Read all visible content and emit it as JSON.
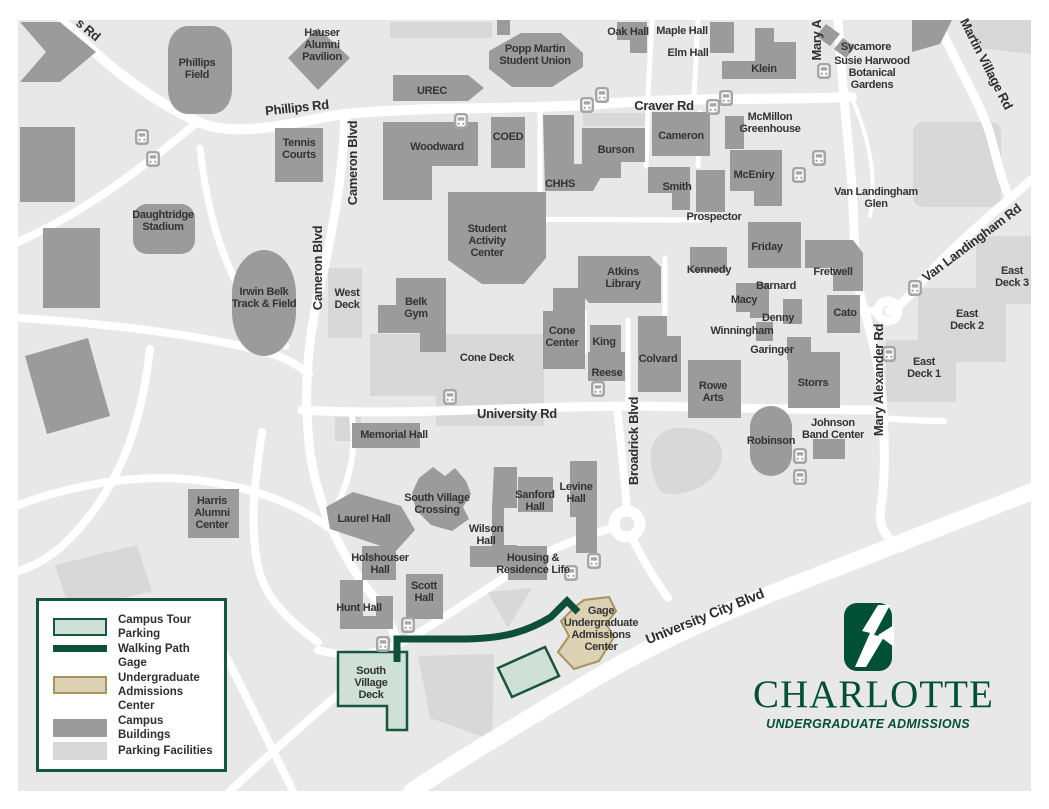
{
  "legend": {
    "items": [
      {
        "id": "campus-tour-parking",
        "label": "Campus Tour Parking",
        "swatch": "tour-parking"
      },
      {
        "id": "walking-path",
        "label": "Walking Path",
        "swatch": "walking-path"
      },
      {
        "id": "gage-center",
        "label": "Gage Undergraduate Admissions Center",
        "swatch": "gage"
      },
      {
        "id": "campus-buildings",
        "label": "Campus Buildings",
        "swatch": "building"
      },
      {
        "id": "parking-facilities",
        "label": "Parking Facilities",
        "swatch": "parking"
      }
    ]
  },
  "branding": {
    "wordmark": "CHARLOTTE",
    "tagline": "UNDERGRADUATE ADMISSIONS"
  },
  "colors": {
    "charlotte_green": "#005035",
    "walking_path": "#0d4f38",
    "tour_parking_fill": "#cfe0d6",
    "tour_parking_border": "#15563c",
    "gage_fill": "#ddd1b3",
    "gage_border": "#a8925e",
    "campus_building": "#9b9b9b",
    "parking": "#d8d8d8",
    "map_background": "#e8e8e8",
    "label_text": "#333333"
  },
  "map": {
    "bus_stops": [
      [
        142,
        137
      ],
      [
        153,
        159
      ],
      [
        461,
        121
      ],
      [
        587,
        105
      ],
      [
        602,
        95
      ],
      [
        713,
        107
      ],
      [
        726,
        98
      ],
      [
        824,
        71
      ],
      [
        819,
        158
      ],
      [
        799,
        175
      ],
      [
        915,
        288
      ],
      [
        889,
        354
      ],
      [
        450,
        397
      ],
      [
        598,
        389
      ],
      [
        800,
        456
      ],
      [
        800,
        477
      ],
      [
        571,
        573
      ],
      [
        594,
        561
      ],
      [
        408,
        625
      ],
      [
        383,
        644
      ]
    ],
    "labels": [
      {
        "id": "s-rd-partial",
        "kind": "road",
        "x": 88,
        "y": 30,
        "text": "s Rd",
        "rotate": 40
      },
      {
        "id": "phillips-rd",
        "kind": "road",
        "x": 297,
        "y": 108,
        "text": "Phillips Rd",
        "rotate": -6
      },
      {
        "id": "craver-rd",
        "kind": "road",
        "x": 664,
        "y": 106,
        "text": "Craver Rd"
      },
      {
        "id": "cameron-blvd-north",
        "kind": "road",
        "x": 353,
        "y": 163,
        "text": "Cameron Blvd",
        "rotate": -90
      },
      {
        "id": "cameron-blvd-south",
        "kind": "road",
        "x": 318,
        "y": 268,
        "text": "Cameron Blvd",
        "rotate": -90
      },
      {
        "id": "mary-a-partial",
        "kind": "road",
        "x": 817,
        "y": 40,
        "text": "Mary A",
        "rotate": -90
      },
      {
        "id": "martin-village-rd",
        "kind": "road",
        "x": 986,
        "y": 64,
        "text": "Martin Village Rd",
        "rotate": 63
      },
      {
        "id": "van-landingham-rd",
        "kind": "road",
        "x": 972,
        "y": 243,
        "text": "Van Landingham Rd",
        "rotate": -37
      },
      {
        "id": "mary-alexander-rd",
        "kind": "road",
        "x": 879,
        "y": 380,
        "text": "Mary Alexander Rd",
        "rotate": -90
      },
      {
        "id": "university-rd",
        "kind": "road",
        "x": 517,
        "y": 414,
        "text": "University Rd"
      },
      {
        "id": "broadrick-blvd",
        "kind": "road",
        "x": 634,
        "y": 441,
        "text": "Broadrick Blvd",
        "rotate": -90
      },
      {
        "id": "university-city-blvd",
        "kind": "road",
        "x": 705,
        "y": 617,
        "text": "University City Blvd",
        "rotate": -22,
        "size": 14
      },
      {
        "id": "susie-harwood-botanical-gardens",
        "kind": "area",
        "x": 872,
        "y": 72,
        "lines": [
          "Susie Harwood",
          "Botanical",
          "Gardens"
        ]
      },
      {
        "id": "van-landingham-glen",
        "kind": "area",
        "x": 876,
        "y": 197,
        "lines": [
          "Van Landingham",
          "Glen"
        ]
      },
      {
        "id": "phillips-field",
        "kind": "building",
        "x": 197,
        "y": 68,
        "lines": [
          "Phillips",
          "Field"
        ]
      },
      {
        "id": "hauser-alumni-pavilion",
        "kind": "building",
        "x": 322,
        "y": 44,
        "lines": [
          "Hauser",
          "Alumni",
          "Pavilion"
        ]
      },
      {
        "id": "tennis-courts",
        "kind": "building",
        "x": 299,
        "y": 148,
        "lines": [
          "Tennis",
          "Courts"
        ]
      },
      {
        "id": "daughtridge-stadium",
        "kind": "building",
        "x": 163,
        "y": 220,
        "lines": [
          "Daughtridge",
          "Stadium"
        ]
      },
      {
        "id": "urec",
        "kind": "building",
        "x": 432,
        "y": 90,
        "text": "UREC"
      },
      {
        "id": "popp-martin-student-union",
        "kind": "building",
        "x": 535,
        "y": 54,
        "lines": [
          "Popp Martin",
          "Student Union"
        ]
      },
      {
        "id": "oak-hall",
        "kind": "building",
        "x": 628,
        "y": 31,
        "text": "Oak Hall"
      },
      {
        "id": "maple-hall",
        "kind": "building",
        "x": 682,
        "y": 30,
        "text": "Maple Hall"
      },
      {
        "id": "elm-hall",
        "kind": "building",
        "x": 688,
        "y": 52,
        "text": "Elm Hall"
      },
      {
        "id": "klein",
        "kind": "building",
        "x": 764,
        "y": 68,
        "text": "Klein"
      },
      {
        "id": "sycamore",
        "kind": "building",
        "x": 866,
        "y": 46,
        "text": "Sycamore"
      },
      {
        "id": "woodward",
        "kind": "building",
        "x": 437,
        "y": 146,
        "text": "Woodward"
      },
      {
        "id": "coed",
        "kind": "building",
        "x": 508,
        "y": 136,
        "text": "COED"
      },
      {
        "id": "chhs",
        "kind": "building",
        "x": 560,
        "y": 183,
        "text": "CHHS"
      },
      {
        "id": "burson",
        "kind": "building",
        "x": 616,
        "y": 149,
        "text": "Burson"
      },
      {
        "id": "cameron",
        "kind": "building",
        "x": 681,
        "y": 135,
        "text": "Cameron"
      },
      {
        "id": "mcmillon-greenhouse",
        "kind": "building",
        "x": 770,
        "y": 122,
        "lines": [
          "McMillon",
          "Greenhouse"
        ]
      },
      {
        "id": "mceniry",
        "kind": "building",
        "x": 754,
        "y": 174,
        "text": "McEniry"
      },
      {
        "id": "smith",
        "kind": "building",
        "x": 677,
        "y": 186,
        "text": "Smith"
      },
      {
        "id": "prospector",
        "kind": "building",
        "x": 714,
        "y": 216,
        "text": "Prospector"
      },
      {
        "id": "friday",
        "kind": "building",
        "x": 767,
        "y": 246,
        "text": "Friday"
      },
      {
        "id": "kennedy",
        "kind": "building",
        "x": 709,
        "y": 269,
        "text": "Kennedy"
      },
      {
        "id": "barnard",
        "kind": "building",
        "x": 776,
        "y": 285,
        "text": "Barnard"
      },
      {
        "id": "macy",
        "kind": "building",
        "x": 744,
        "y": 299,
        "text": "Macy"
      },
      {
        "id": "denny",
        "kind": "building",
        "x": 778,
        "y": 317,
        "text": "Denny"
      },
      {
        "id": "winningham",
        "kind": "building",
        "x": 742,
        "y": 330,
        "text": "Winningham"
      },
      {
        "id": "garinger",
        "kind": "building",
        "x": 772,
        "y": 349,
        "text": "Garinger"
      },
      {
        "id": "fretwell",
        "kind": "building",
        "x": 833,
        "y": 271,
        "text": "Fretwell"
      },
      {
        "id": "cato",
        "kind": "building",
        "x": 845,
        "y": 312,
        "text": "Cato"
      },
      {
        "id": "east-deck-3",
        "kind": "deck",
        "x": 1012,
        "y": 276,
        "lines": [
          "East",
          "Deck 3"
        ]
      },
      {
        "id": "east-deck-2",
        "kind": "deck",
        "x": 967,
        "y": 319,
        "lines": [
          "East",
          "Deck 2"
        ]
      },
      {
        "id": "east-deck-1",
        "kind": "deck",
        "x": 924,
        "y": 367,
        "lines": [
          "East",
          "Deck 1"
        ]
      },
      {
        "id": "atkins-library",
        "kind": "building",
        "x": 623,
        "y": 277,
        "lines": [
          "Atkins",
          "Library"
        ]
      },
      {
        "id": "student-activity-center",
        "kind": "building",
        "x": 487,
        "y": 240,
        "lines": [
          "Student",
          "Activity",
          "Center"
        ]
      },
      {
        "id": "west-deck",
        "kind": "deck",
        "x": 347,
        "y": 298,
        "lines": [
          "West",
          "Deck"
        ]
      },
      {
        "id": "belk-gym",
        "kind": "building",
        "x": 416,
        "y": 307,
        "lines": [
          "Belk",
          "Gym"
        ]
      },
      {
        "id": "cone-deck",
        "kind": "deck",
        "x": 487,
        "y": 357,
        "text": "Cone Deck"
      },
      {
        "id": "cone-center",
        "kind": "building",
        "x": 562,
        "y": 336,
        "lines": [
          "Cone",
          "Center"
        ]
      },
      {
        "id": "king",
        "kind": "building",
        "x": 604,
        "y": 341,
        "text": "King"
      },
      {
        "id": "reese",
        "kind": "building",
        "x": 607,
        "y": 372,
        "text": "Reese"
      },
      {
        "id": "colvard",
        "kind": "building",
        "x": 658,
        "y": 358,
        "text": "Colvard"
      },
      {
        "id": "irwin-belk-track-field",
        "kind": "building",
        "x": 264,
        "y": 297,
        "lines": [
          "Irwin Belk",
          "Track & Field"
        ]
      },
      {
        "id": "rowe-arts",
        "kind": "building",
        "x": 713,
        "y": 391,
        "lines": [
          "Rowe",
          "Arts"
        ]
      },
      {
        "id": "storrs",
        "kind": "building",
        "x": 813,
        "y": 382,
        "text": "Storrs"
      },
      {
        "id": "johnson-band-center",
        "kind": "building",
        "x": 833,
        "y": 428,
        "lines": [
          "Johnson",
          "Band Center"
        ]
      },
      {
        "id": "robinson",
        "kind": "building",
        "x": 771,
        "y": 440,
        "text": "Robinson"
      },
      {
        "id": "memorial-hall",
        "kind": "building",
        "x": 394,
        "y": 434,
        "text": "Memorial Hall"
      },
      {
        "id": "harris-alumni-center",
        "kind": "building",
        "x": 212,
        "y": 512,
        "lines": [
          "Harris",
          "Alumni",
          "Center"
        ]
      },
      {
        "id": "laurel-hall",
        "kind": "building",
        "x": 364,
        "y": 518,
        "text": "Laurel Hall"
      },
      {
        "id": "south-village-crossing",
        "kind": "building",
        "x": 437,
        "y": 503,
        "lines": [
          "South Village",
          "Crossing"
        ]
      },
      {
        "id": "wilson-hall",
        "kind": "building",
        "x": 486,
        "y": 534,
        "lines": [
          "Wilson",
          "Hall"
        ]
      },
      {
        "id": "sanford-hall",
        "kind": "building",
        "x": 535,
        "y": 500,
        "lines": [
          "Sanford",
          "Hall"
        ]
      },
      {
        "id": "levine-hall",
        "kind": "building",
        "x": 576,
        "y": 492,
        "lines": [
          "Levine",
          "Hall"
        ]
      },
      {
        "id": "holshouser-hall",
        "kind": "building",
        "x": 380,
        "y": 563,
        "lines": [
          "Holshouser",
          "Hall"
        ]
      },
      {
        "id": "scott-hall",
        "kind": "building",
        "x": 424,
        "y": 591,
        "lines": [
          "Scott",
          "Hall"
        ]
      },
      {
        "id": "hunt-hall",
        "kind": "building",
        "x": 359,
        "y": 607,
        "text": "Hunt Hall"
      },
      {
        "id": "housing-residence-life",
        "kind": "building",
        "x": 533,
        "y": 563,
        "lines": [
          "Housing &",
          "Residence Life"
        ]
      },
      {
        "id": "south-village-deck",
        "kind": "deck",
        "x": 371,
        "y": 682,
        "lines": [
          "South",
          "Village",
          "Deck"
        ]
      },
      {
        "id": "gage-undergraduate-admissions-center",
        "kind": "building",
        "x": 601,
        "y": 628,
        "lines": [
          "Gage",
          "Undergraduate",
          "Admissions",
          "Center"
        ]
      }
    ]
  }
}
